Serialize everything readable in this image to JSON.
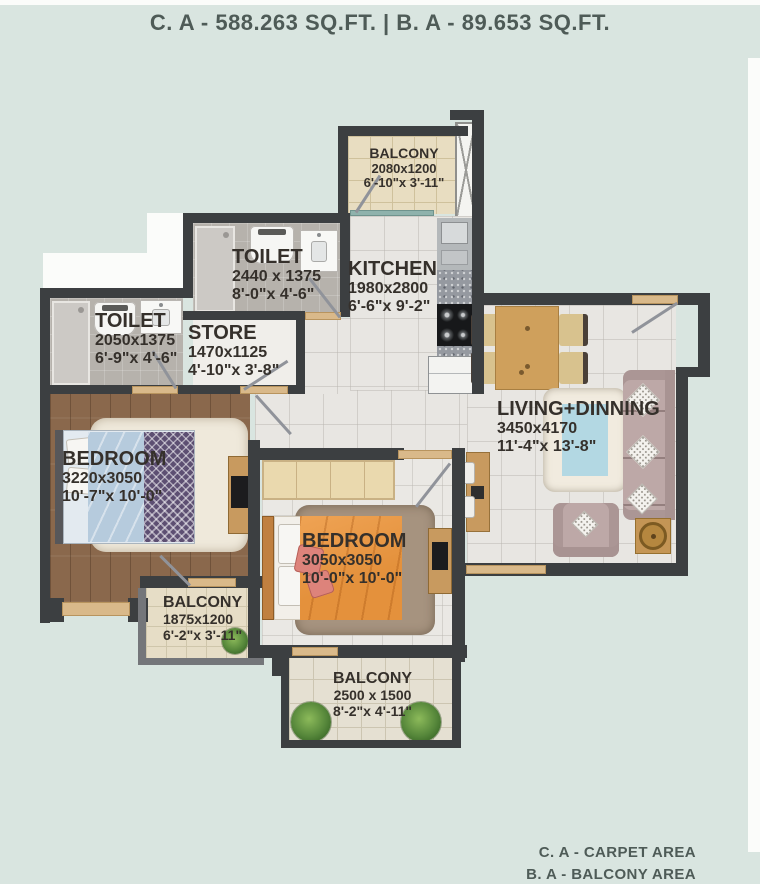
{
  "header": {
    "area_line": "C. A - 588.263 SQ.FT. | B. A - 89.653 SQ.FT."
  },
  "legend": {
    "carpet": "C. A - CARPET AREA",
    "balcony": "B. A - BALCONY AREA"
  },
  "rooms": {
    "balcony_top": {
      "name": "BALCONY",
      "mm": "2080x1200",
      "ft": "6'-10\"x 3'-11\""
    },
    "toilet_top": {
      "name": "TOILET",
      "mm": "2440 x 1375",
      "ft": "8'-0\"x 4'-6\""
    },
    "kitchen": {
      "name": "KITCHEN",
      "mm": "1980x2800",
      "ft": "6'-6\"x 9'-2\""
    },
    "toilet_left": {
      "name": "TOILET",
      "mm": "2050x1375",
      "ft": "6'-9\"x 4'-6\""
    },
    "store": {
      "name": "STORE",
      "mm": "1470x1125",
      "ft": "4'-10\"x 3'-8\""
    },
    "living": {
      "name": "LIVING+DINNING",
      "mm": "3450x4170",
      "ft": "11'-4\"x 13'-8\""
    },
    "bedroom_left": {
      "name": "BEDROOM",
      "mm": "3220x3050",
      "ft": "10'-7\"x 10'-0\""
    },
    "bedroom_mid": {
      "name": "BEDROOM",
      "mm": "3050x3050",
      "ft": "10'-0\"x 10'-0\""
    },
    "balcony_left": {
      "name": "BALCONY",
      "mm": "1875x1200",
      "ft": "6'-2\"x 3'-11\""
    },
    "balcony_bottom": {
      "name": "BALCONY",
      "mm": "2500 x 1500",
      "ft": "8'-2\"x 4'-11\""
    }
  },
  "colors": {
    "background": "#d9e5e0",
    "wall": "#3c3f41",
    "door_tan": "#d9b98a",
    "window_teal": "#8fb2ac",
    "wood_floor": "#8a684c",
    "bed_orange": "#e4913c",
    "bed_blue": "#b6cbdd",
    "sofa_mauve": "#bda8a7",
    "label_text": "#35302b",
    "header_text": "#4e5b57"
  }
}
